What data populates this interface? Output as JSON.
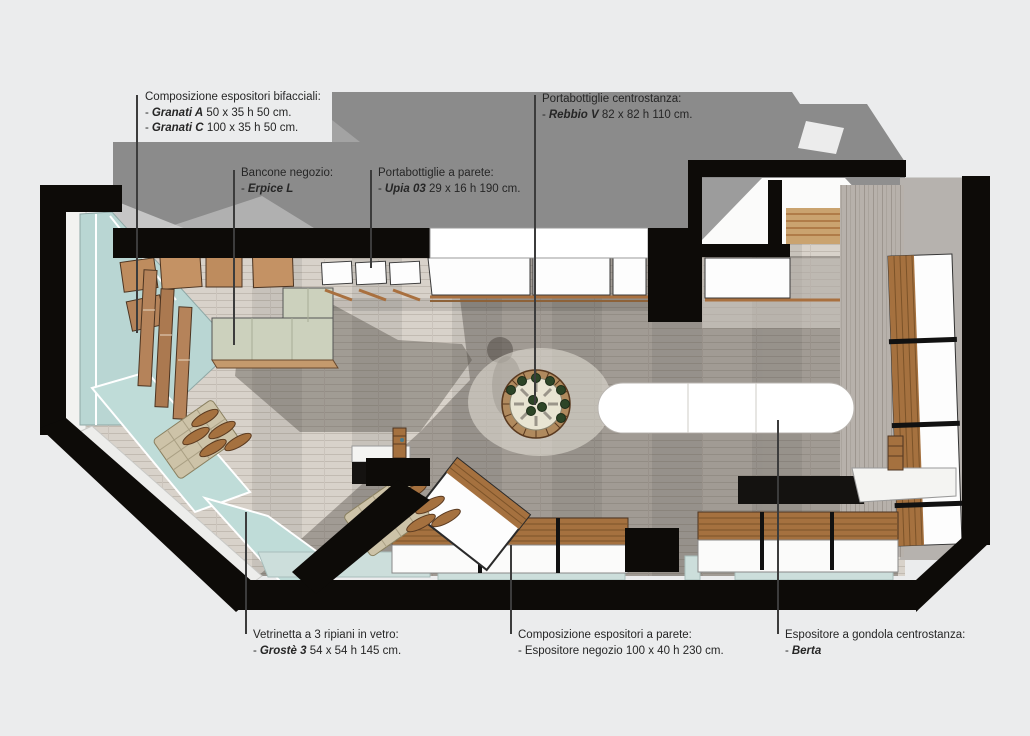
{
  "figure": {
    "type": "shop-interior-floor-plan",
    "background": "#ebeced",
    "item_prefix": "-"
  },
  "palette": {
    "wall_black": "#0d0b08",
    "building_shadow_gray": "#8b8b8b",
    "floor_wood": "#d8d2ca",
    "glass_teal": "#b9d6d3",
    "furniture_wood": "#be8c5e",
    "bottle_green": "#2d4527",
    "unit_white": "#fdfdfd"
  },
  "labels": {
    "bifacciali": {
      "title": "Composizione espositori bifacciali:",
      "items": [
        {
          "name": "Granati A",
          "dims": "50 x 35 h 50 cm."
        },
        {
          "name": "Granati C",
          "dims": "100 x 35 h 50 cm."
        }
      ]
    },
    "bancone": {
      "title": "Bancone negozio:",
      "items": [
        {
          "name": "Erpice L",
          "dims": ""
        }
      ]
    },
    "portabottiglie_parete": {
      "title": "Portabottiglie a parete:",
      "items": [
        {
          "name": "Upia 03",
          "dims": "29 x 16 h 190 cm."
        }
      ]
    },
    "portabottiglie_centrostanza": {
      "title": "Portabottiglie centrostanza:",
      "items": [
        {
          "name": "Rebbio V",
          "dims": "82 x 82 h 110 cm."
        }
      ]
    },
    "vetrinetta": {
      "title": "Vetrinetta a 3 ripiani in vetro:",
      "items": [
        {
          "name": "Grostè 3",
          "dims": "54 x 54 h 145 cm."
        }
      ]
    },
    "espositori_parete": {
      "title": "Composizione espositori a parete:",
      "items": [
        {
          "name": "Espositore negozio",
          "dims": "100 x 40 h 230 cm."
        }
      ]
    },
    "gondola": {
      "title": "Espositore a gondola centrostanza:",
      "items": [
        {
          "name": "Berta",
          "dims": ""
        }
      ]
    }
  }
}
